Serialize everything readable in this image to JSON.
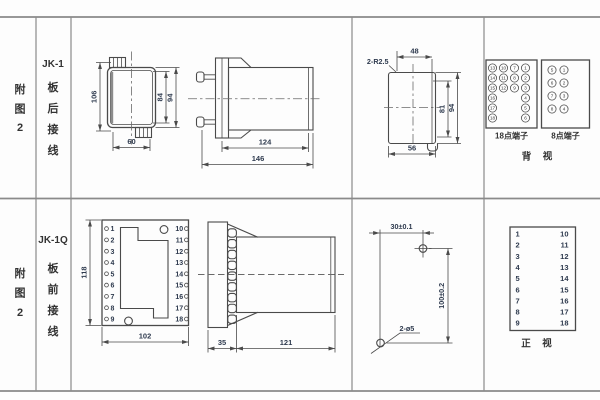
{
  "colors": {
    "background": "#fdfdfd",
    "line": "#4a4a4a",
    "grid_line": "#8a8a8a",
    "label_text": "#333333",
    "dim_text": "#2e3a4e"
  },
  "figure": {
    "row1": {
      "side": [
        "附",
        "图",
        "2"
      ],
      "model": "JK-1",
      "wiring": [
        "板",
        "后",
        "接",
        "线"
      ]
    },
    "row2": {
      "side": [
        "附",
        "图",
        "2"
      ],
      "model": "JK-1Q",
      "wiring": [
        "板",
        "前",
        "接",
        "线"
      ]
    }
  },
  "rear_case_view": {
    "dims": {
      "total_height": "106",
      "inner_height": "84",
      "case_height": "94",
      "width": "60"
    }
  },
  "side_view_rear": {
    "dims": {
      "body": "124",
      "total": "146"
    }
  },
  "top_view": {
    "corner": "2-R2.5",
    "dims": {
      "top": "48",
      "inner": "81",
      "outer": "94",
      "bottom": "56"
    }
  },
  "rear_terminals": {
    "t18": {
      "label": "18点端子",
      "grid": [
        [
          "13",
          "10",
          "7",
          "1"
        ],
        [
          "14",
          "11",
          "8",
          "2"
        ],
        [
          "15",
          "12",
          "9",
          "3"
        ],
        [
          "16",
          "",
          "",
          "4"
        ],
        [
          "17",
          "",
          "",
          "5"
        ],
        [
          "18",
          "",
          "",
          "6"
        ]
      ]
    },
    "t8": {
      "label": "8点端子",
      "grid": [
        [
          "5",
          "1"
        ],
        [
          "6",
          "2"
        ],
        [
          "7",
          "3"
        ],
        [
          "8",
          "4"
        ]
      ]
    },
    "view_label": "背　视"
  },
  "front_socket": {
    "dims": {
      "height": "118",
      "width": "102"
    },
    "left_terminals": [
      "1",
      "2",
      "3",
      "4",
      "5",
      "6",
      "7",
      "8",
      "9"
    ],
    "right_terminals": [
      "10",
      "11",
      "12",
      "13",
      "14",
      "15",
      "16",
      "17",
      "18"
    ]
  },
  "side_view_front": {
    "dims": {
      "plate": "35",
      "body": "121"
    }
  },
  "drill_template": {
    "dim_horizontal": "30±0.1",
    "dim_vertical": "100±0.2",
    "holes_label": "2-ø5"
  },
  "front_terminals_table": {
    "left": [
      "1",
      "2",
      "3",
      "4",
      "5",
      "6",
      "7",
      "8",
      "9"
    ],
    "right": [
      "10",
      "11",
      "12",
      "13",
      "14",
      "15",
      "16",
      "17",
      "18"
    ],
    "view_label": "正　视"
  }
}
